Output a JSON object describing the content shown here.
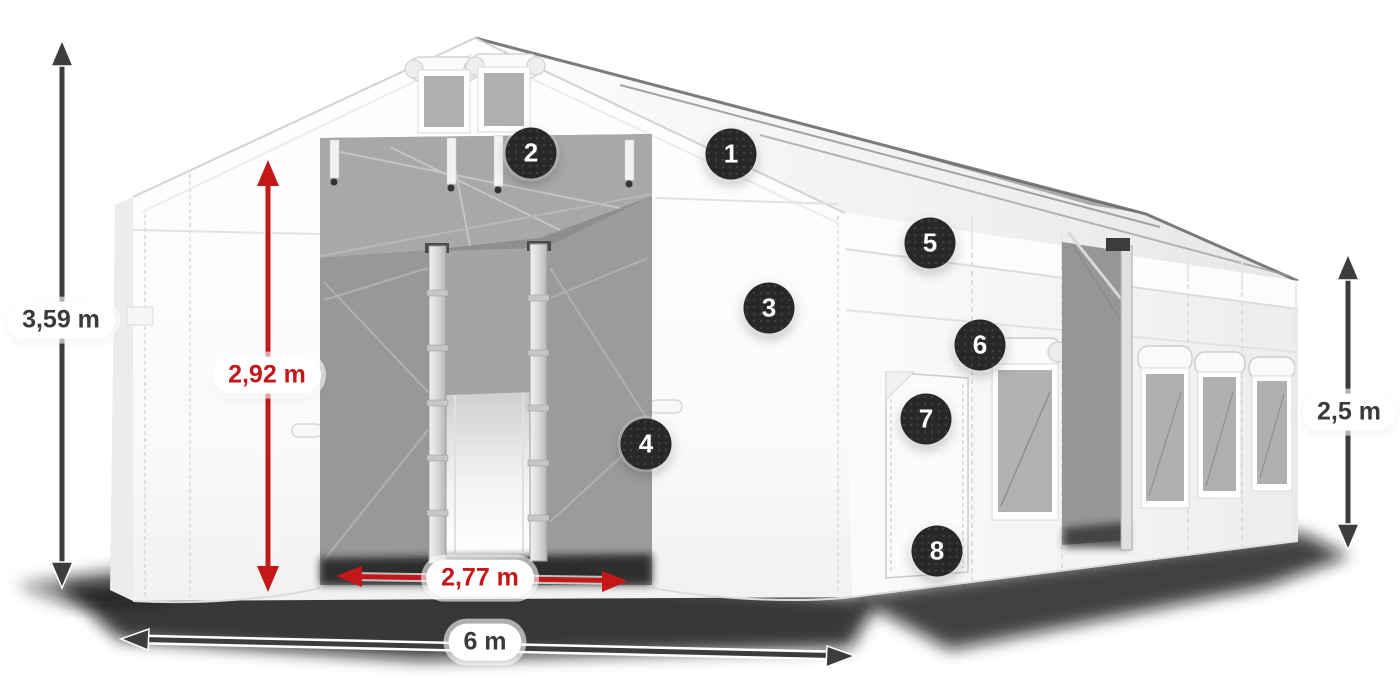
{
  "dimensions": {
    "overall_height": {
      "value": "3,59 m"
    },
    "door_height": {
      "value": "2,92 m"
    },
    "door_width": {
      "value": "2,77 m"
    },
    "overall_width": {
      "value": "6 m"
    },
    "side_wall_height": {
      "value": "2,5 m"
    }
  },
  "callouts": [
    {
      "number": "1"
    },
    {
      "number": "2"
    },
    {
      "number": "3"
    },
    {
      "number": "4"
    },
    {
      "number": "5"
    },
    {
      "number": "6"
    },
    {
      "number": "7"
    },
    {
      "number": "8"
    }
  ],
  "colors": {
    "dimension_accent_red": "#c4171a",
    "dimension_arrow_dark": "#3d3d3d",
    "callout_badge_bg": "#282828",
    "callout_badge_text": "#ffffff"
  }
}
